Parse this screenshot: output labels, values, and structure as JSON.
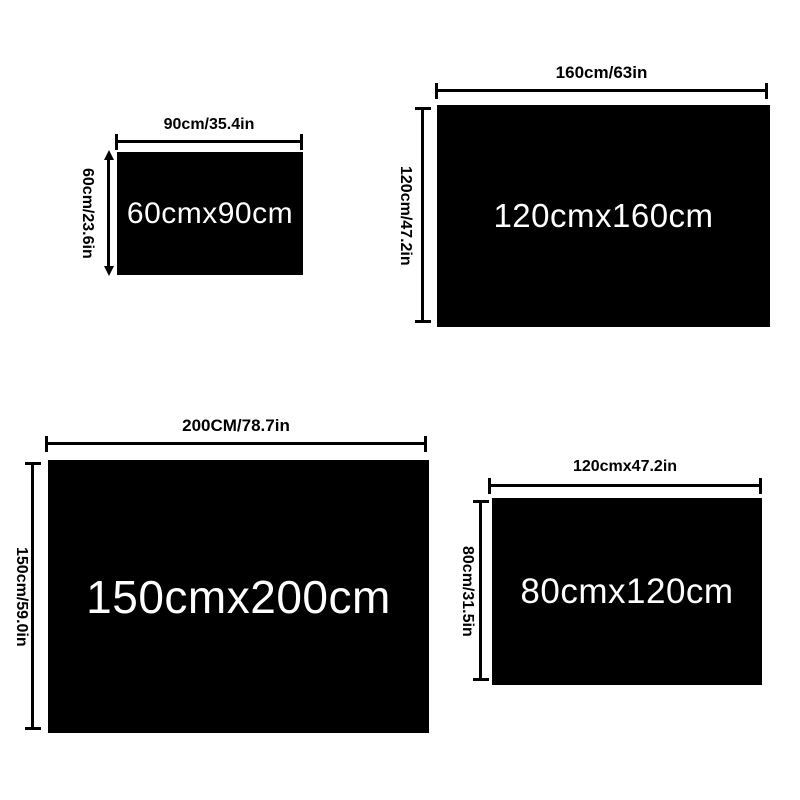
{
  "colors": {
    "background": "#ffffff",
    "swatch_fill": "#000000",
    "swatch_text": "#ffffff",
    "dimension_lines": "#000000",
    "label_text": "#000000"
  },
  "sizes": [
    {
      "size_label": "60cmx90cm",
      "width_label": "90cm/35.4in",
      "height_label": "60cm/23.6in"
    },
    {
      "size_label": "120cmx160cm",
      "width_label": "160cm/63in",
      "height_label": "120cm/47.2in"
    },
    {
      "size_label": "150cmx200cm",
      "width_label": "200CM/78.7in",
      "height_label": "150cm/59.0in"
    },
    {
      "size_label": "80cmx120cm",
      "width_label": "120cmx47.2in",
      "height_label": "80cm/31.5in"
    }
  ]
}
